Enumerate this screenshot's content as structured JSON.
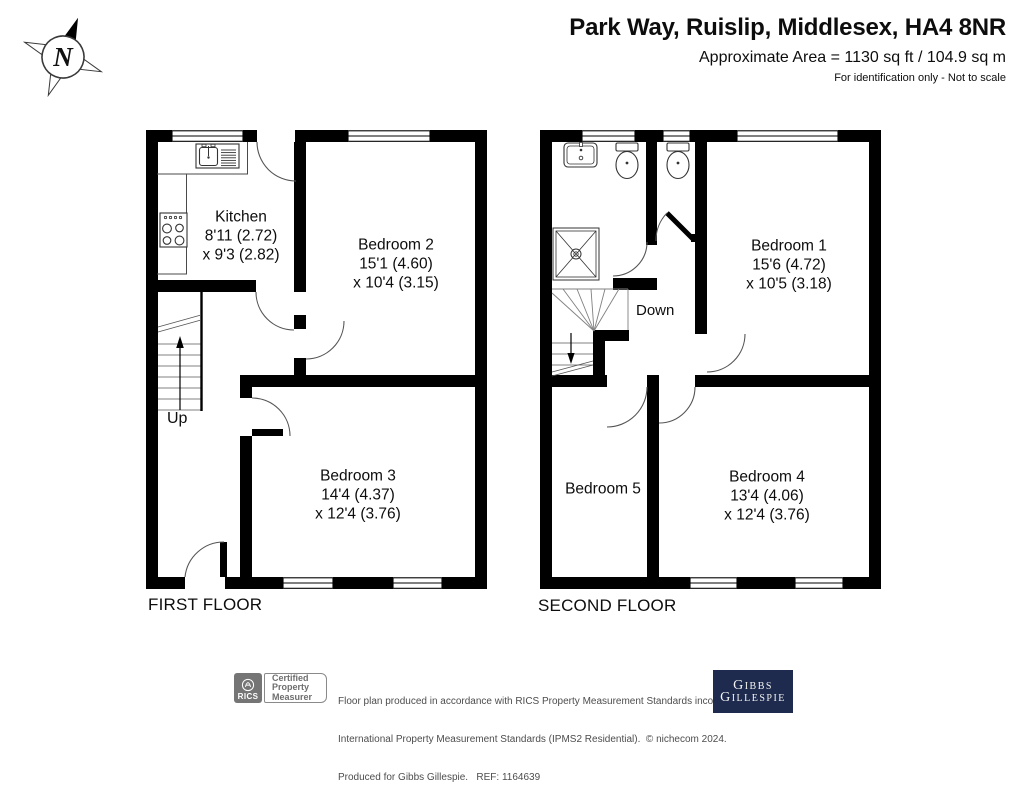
{
  "header": {
    "title": "Park Way, Ruislip, Middlesex, HA4 8NR",
    "area": "Approximate Area = 1130 sq ft / 104.9 sq m",
    "disclaimer": "For identification only - Not to scale"
  },
  "compass": {
    "label": "N"
  },
  "floors": [
    {
      "label": "FIRST FLOOR",
      "stairs_label": "Up",
      "rooms": [
        {
          "name": "Kitchen",
          "dim1": "8'11 (2.72)",
          "dim2": "x 9'3 (2.82)"
        },
        {
          "name": "Bedroom 2",
          "dim1": "15'1 (4.60)",
          "dim2": "x 10'4 (3.15)"
        },
        {
          "name": "Bedroom 3",
          "dim1": "14'4 (4.37)",
          "dim2": "x 12'4 (3.76)"
        }
      ]
    },
    {
      "label": "SECOND FLOOR",
      "stairs_label": "Down",
      "rooms": [
        {
          "name": "Bedroom 1",
          "dim1": "15'6 (4.72)",
          "dim2": "x 10'5 (3.18)"
        },
        {
          "name": "Bedroom 5"
        },
        {
          "name": "Bedroom 4",
          "dim1": "13'4 (4.06)",
          "dim2": "x 12'4 (3.76)"
        }
      ]
    }
  ],
  "footer": {
    "rics_label": "RICS",
    "cert_lines": [
      "Certified",
      "Property",
      "Measurer"
    ],
    "disclaimer_lines": [
      "Floor plan produced in accordance with RICS Property Measurement Standards incorporating",
      "International Property Measurement Standards (IPMS2 Residential).  © nichecom 2024.",
      "Produced for Gibbs Gillespie.   REF: 1164639"
    ],
    "brand_lines": [
      "Gibbs",
      "Gillespie"
    ]
  },
  "colors": {
    "wall": "#000000",
    "brand_navy": "#1e2b4e",
    "rics_gray": "#757575",
    "text": "#111111"
  }
}
